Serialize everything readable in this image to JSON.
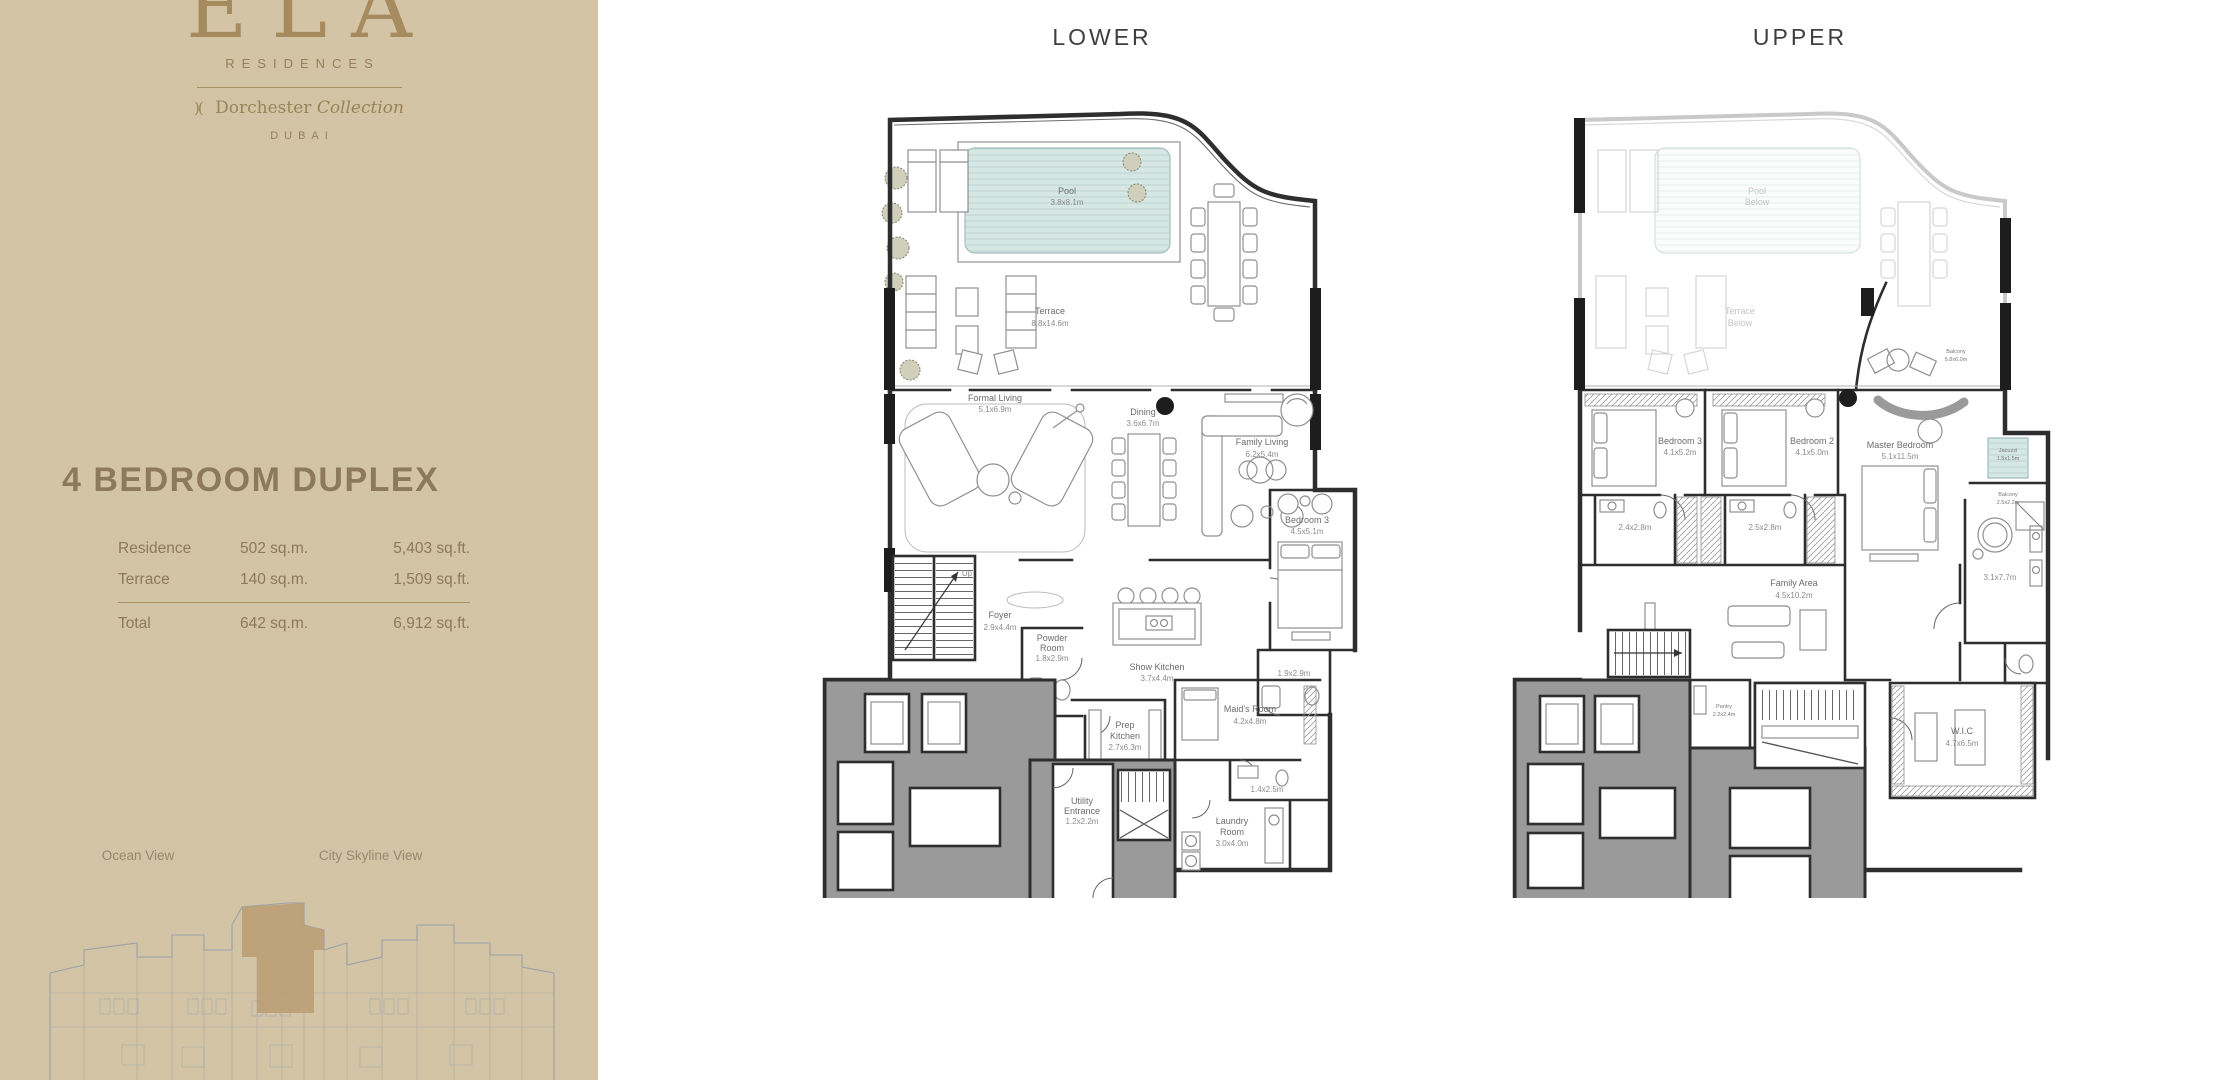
{
  "sidebar": {
    "logo": {
      "brand": "ELA",
      "residences": "RESIDENCES",
      "mark": ")(",
      "collection_name": "Dorchester",
      "collection_word": "Collection",
      "city": "DUBAI"
    },
    "title": "4 BEDROOM DUPLEX",
    "areas": {
      "rows": [
        {
          "label": "Residence",
          "sqm": "502 sq.m.",
          "sqft": "5,403 sq.ft."
        },
        {
          "label": "Terrace",
          "sqm": "140 sq.m.",
          "sqft": "1,509 sq.ft."
        }
      ],
      "total": {
        "label": "Total",
        "sqm": "642 sq.m.",
        "sqft": "6,912 sq.ft."
      }
    },
    "views": {
      "left": "Ocean View",
      "right": "City Skyline View"
    }
  },
  "plans": {
    "lower": {
      "title": "LOWER",
      "labels": {
        "pool": {
          "n1": "Pool",
          "dim": "3.8x8.1m"
        },
        "terrace": {
          "n1": "Terrace",
          "dim": "8.8x14.6m"
        },
        "formal": {
          "n1": "Formal Living",
          "dim": "5.1x6.9m"
        },
        "dining": {
          "n1": "Dining",
          "dim": "3.6x6.7m"
        },
        "family": {
          "n1": "Family Living",
          "dim": "6.2x5.4m"
        },
        "foyer": {
          "n1": "Foyer",
          "dim": "2.9x4.4m"
        },
        "powder": {
          "n1": "Powder",
          "n2": "Room",
          "dim": "1.8x2.9m"
        },
        "show_kitchen": {
          "n1": "Show Kitchen",
          "dim": "3.7x4.4m"
        },
        "bedroom3": {
          "n1": "Bedroom 3",
          "dim": "4.5x5.1m"
        },
        "bath3": {
          "dim": "1.9x2.9m"
        },
        "prep": {
          "n1": "Prep",
          "n2": "Kitchen",
          "dim": "2.7x6.3m"
        },
        "maids": {
          "n1": "Maid's Room",
          "dim": "4.2x4.8m"
        },
        "maids_bath": {
          "dim": "1.4x2.5m"
        },
        "utility": {
          "n1": "Utility",
          "n2": "Entrance",
          "dim": "1.2x2.2m"
        },
        "laundry": {
          "n1": "Laundry",
          "n2": "Room",
          "dim": "3.0x4.0m"
        },
        "up": "Up"
      }
    },
    "upper": {
      "title": "UPPER",
      "labels": {
        "pool_below": {
          "n1": "Pool",
          "n2": "Below"
        },
        "terrace_below": {
          "n1": "Terrace",
          "n2": "Below"
        },
        "balcony_top": {
          "n1": "Balcony",
          "dim": "5.8x6.0m"
        },
        "bedroom3": {
          "n1": "Bedroom 3",
          "dim": "4.1x5.2m"
        },
        "bedroom2": {
          "n1": "Bedroom 2",
          "dim": "4.1x5.0m"
        },
        "master": {
          "n1": "Master Bedroom",
          "dim": "5.1x11.5m"
        },
        "bath3": {
          "dim": "2.4x2.8m"
        },
        "bath2": {
          "dim": "2.5x2.8m"
        },
        "family": {
          "n1": "Family Area",
          "dim": "4.5x10.2m"
        },
        "jacuzzi": {
          "n1": "Jacuzzi",
          "dim": "1.5x1.5m"
        },
        "balcony": {
          "n1": "Balcony",
          "dim": "2.5x2.2m"
        },
        "master_bath": {
          "dim": "3.1x7.7m"
        },
        "wic": {
          "n1": "W.I.C",
          "dim": "4.7x6.5m"
        },
        "pantry": {
          "n1": "Pantry",
          "dim": "2.2x2.4m"
        }
      }
    }
  },
  "colors": {
    "sidebar_bg": "#d2c4a4",
    "brand": "#a68b5f",
    "sidebar_text": "#8c7a5a",
    "plan_title": "#3f3f3f",
    "pool": "#d6e7e4",
    "wall": "#2e2e2e",
    "core_gray": "#9a9a9a",
    "siteplan_line": "#8d99ad",
    "siteplan_highlight": "#bb9e74"
  }
}
